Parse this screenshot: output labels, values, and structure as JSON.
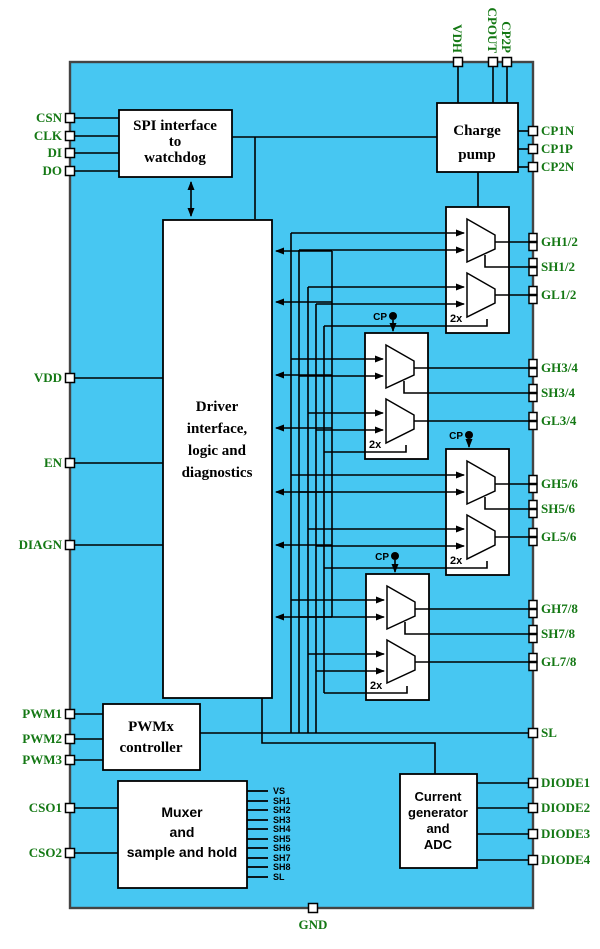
{
  "colors": {
    "chip_fill": "#47C7F2",
    "chip_border": "#444444",
    "wire": "#000000",
    "pin_label_green": "#147814",
    "block_fill": "#FFFFFF"
  },
  "blocks": {
    "spi": {
      "line1": "SPI interface",
      "line2": "to",
      "line3": "watchdog"
    },
    "charge_pump": {
      "line1": "Charge",
      "line2": "pump"
    },
    "driver_logic": {
      "line1": "Driver",
      "line2": "interface,",
      "line3": "logic and",
      "line4": "diagnostics"
    },
    "pwm_controller": {
      "line1": "PWMx",
      "line2": "controller"
    },
    "muxer": {
      "line1": "Muxer",
      "line2": "and",
      "line3": "sample and hold"
    },
    "current_adc": {
      "line1": "Current",
      "line2": "generator",
      "line3": "and",
      "line4": "ADC"
    }
  },
  "stages": [
    {
      "multiplier": "2x"
    },
    {
      "multiplier": "2x",
      "cp": "CP"
    },
    {
      "multiplier": "2x",
      "cp": "CP"
    },
    {
      "multiplier": "2x",
      "cp": "CP"
    }
  ],
  "pins": {
    "top": [
      "VDH",
      "CPOUT",
      "CP2P"
    ],
    "left": [
      "CSN",
      "CLK",
      "DI",
      "DO",
      "VDD",
      "EN",
      "DIAGN",
      "PWM1",
      "PWM2",
      "PWM3",
      "CSO1",
      "CSO2"
    ],
    "right": [
      "CP1N",
      "CP1P",
      "CP2N",
      "GH1/2",
      "SH1/2",
      "GL1/2",
      "GH3/4",
      "SH3/4",
      "GL3/4",
      "GH5/6",
      "SH5/6",
      "GL5/6",
      "GH7/8",
      "SH7/8",
      "GL7/8",
      "SL",
      "DIODE1",
      "DIODE2",
      "DIODE3",
      "DIODE4"
    ],
    "bottom": [
      "GND"
    ]
  },
  "mux_outputs": [
    "VS",
    "SH1",
    "SH2",
    "SH3",
    "SH4",
    "SH5",
    "SH6",
    "SH7",
    "SH8",
    "SL"
  ]
}
